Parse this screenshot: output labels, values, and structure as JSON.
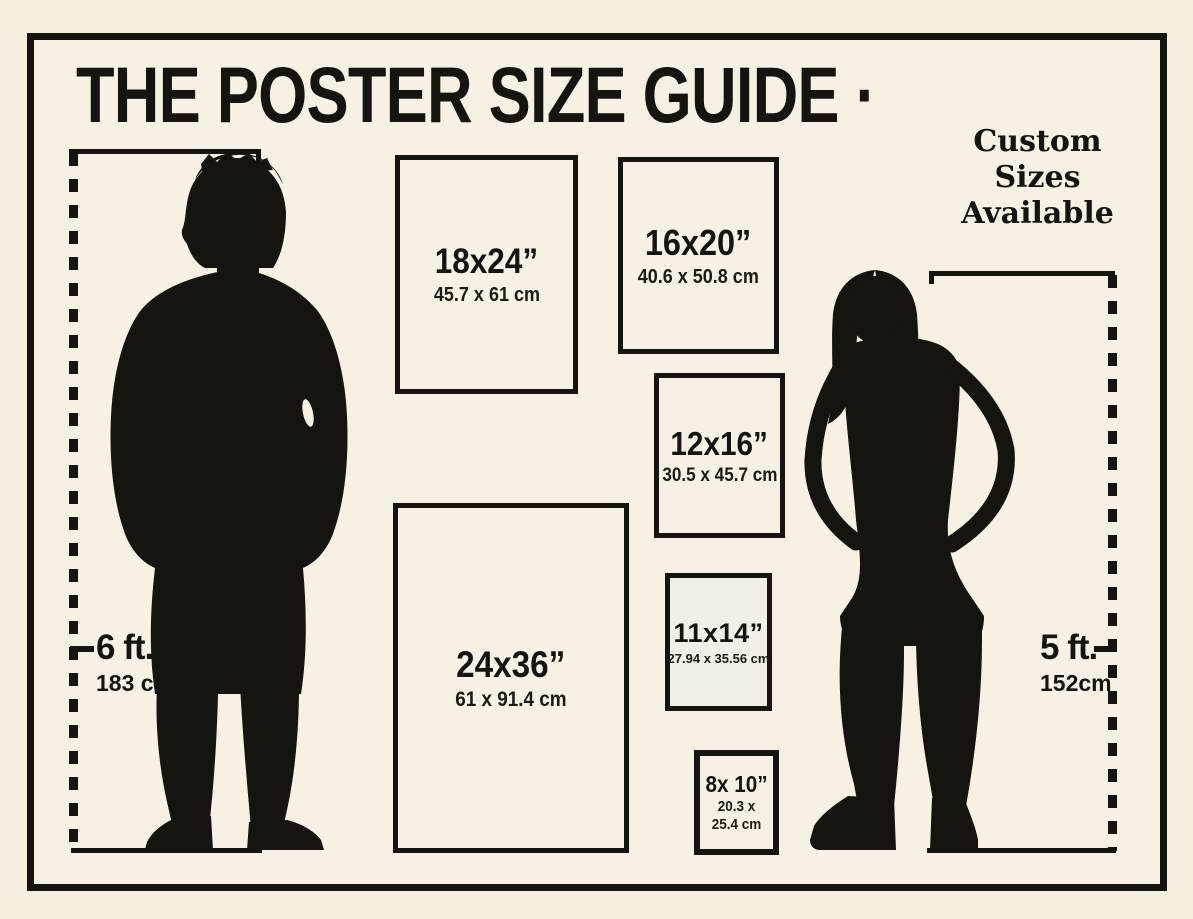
{
  "page": {
    "title": "THE POSTER SIZE GUIDE ·",
    "note_lines": [
      "Custom",
      "Sizes",
      "Available"
    ]
  },
  "sizes": [
    {
      "id": "18x24",
      "inches": "18x24”",
      "cm": "45.7 x 61 cm"
    },
    {
      "id": "16x20",
      "inches": "16x20”",
      "cm": "40.6 x 50.8 cm"
    },
    {
      "id": "12x16",
      "inches": "12x16”",
      "cm": "30.5 x 45.7 cm"
    },
    {
      "id": "24x36",
      "inches": "24x36”",
      "cm": "61 x 91.4 cm"
    },
    {
      "id": "11x14",
      "inches": "11x14”",
      "cm": "27.94 x 35.56 cm"
    },
    {
      "id": "8x10",
      "inches": "8x 10”",
      "cm": "20.3 x 25.4 cm"
    }
  ],
  "figures": {
    "man": {
      "height_ft": "6 ft.",
      "height_cm": "183 cm"
    },
    "woman": {
      "height_ft": "5 ft.",
      "height_cm": "152cm"
    }
  },
  "colors": {
    "background": "#f6f1e4",
    "ink": "#17140f"
  }
}
